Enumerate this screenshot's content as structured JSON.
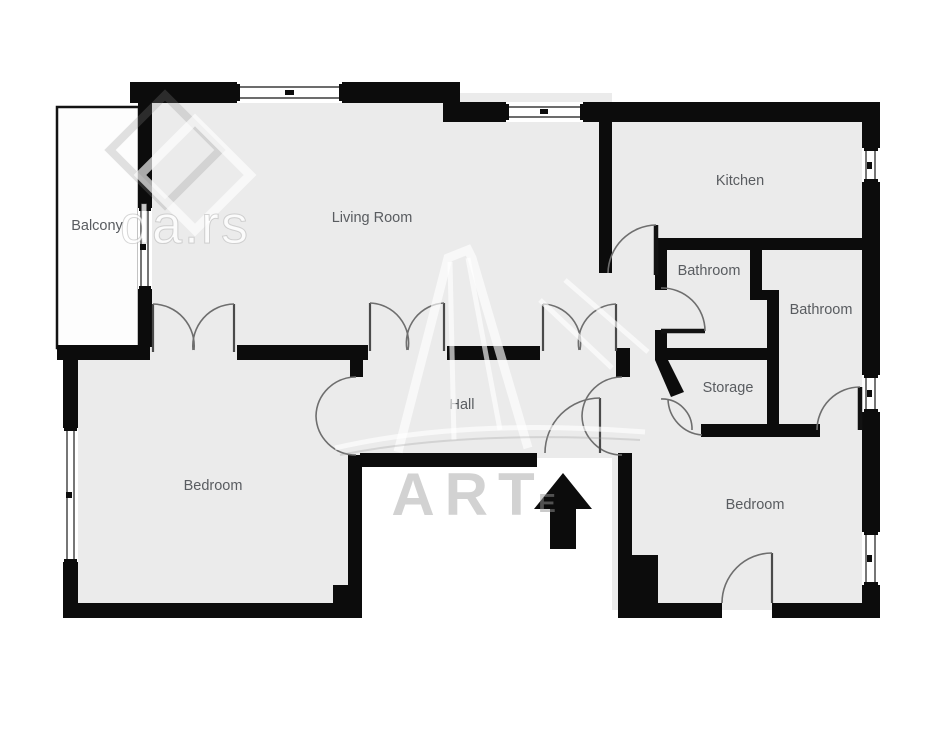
{
  "floorplan": {
    "rooms": [
      {
        "id": "balcony",
        "label": "Balcony"
      },
      {
        "id": "living-room",
        "label": "Living Room"
      },
      {
        "id": "kitchen",
        "label": "Kitchen"
      },
      {
        "id": "bathroom-1",
        "label": "Bathroom"
      },
      {
        "id": "bathroom-2",
        "label": "Bathroom"
      },
      {
        "id": "storage",
        "label": "Storage"
      },
      {
        "id": "hall",
        "label": "Hall"
      },
      {
        "id": "bedroom-left",
        "label": "Bedroom"
      },
      {
        "id": "bedroom-right",
        "label": "Bedroom"
      }
    ],
    "entrance": {
      "symbol": "up-arrow"
    },
    "colors": {
      "background": "#ffffff",
      "wall": "#0c0c0c",
      "room_fill": "#ebebeb",
      "balcony_fill": "#fdfdfd",
      "label_text": "#595c60",
      "door_arc": "#6e6e6e"
    },
    "watermark": {
      "text_primary": "da.rs",
      "text_secondary": "ART",
      "text_tertiary": "E"
    }
  }
}
